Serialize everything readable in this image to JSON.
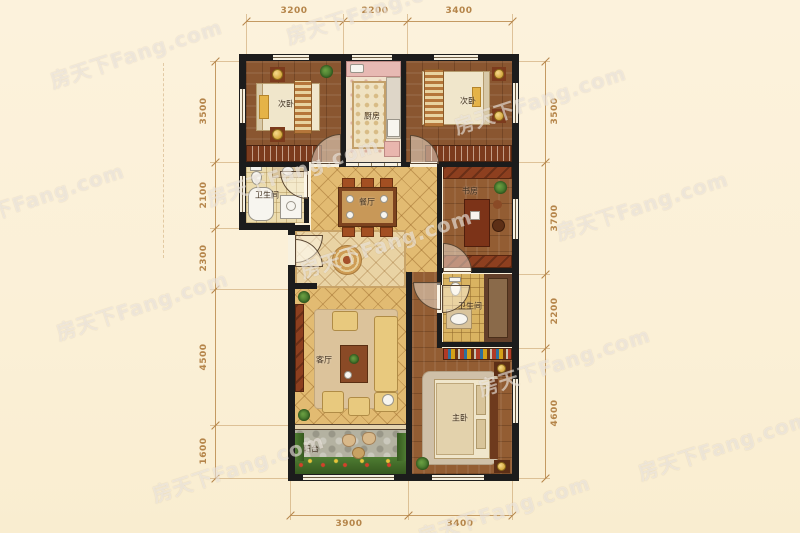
{
  "watermark": {
    "text": "房天下Fang.com"
  },
  "rooms": {
    "bedroom_tl": "次卧",
    "kitchen": "厨房",
    "bedroom_tr": "次卧",
    "bath_left": "卫生间",
    "dining": "餐厅",
    "study": "书房",
    "bath_right": "卫生间",
    "living": "客厅",
    "master": "主卧",
    "balcony": "阳台"
  },
  "dimensions": {
    "top": [
      "3200",
      "2200",
      "3400"
    ],
    "left": [
      "3500",
      "2100",
      "2300",
      "4500",
      "1600"
    ],
    "right": [
      "3500",
      "3700",
      "2200",
      "4600"
    ],
    "bottom": [
      "3900",
      "3400"
    ]
  },
  "colors": {
    "background": "#fbf0d7",
    "wall": "#1c1c1c",
    "dimension": "#b5854a",
    "tile_gold": "#e2bb72",
    "wood": "#8a5630"
  }
}
